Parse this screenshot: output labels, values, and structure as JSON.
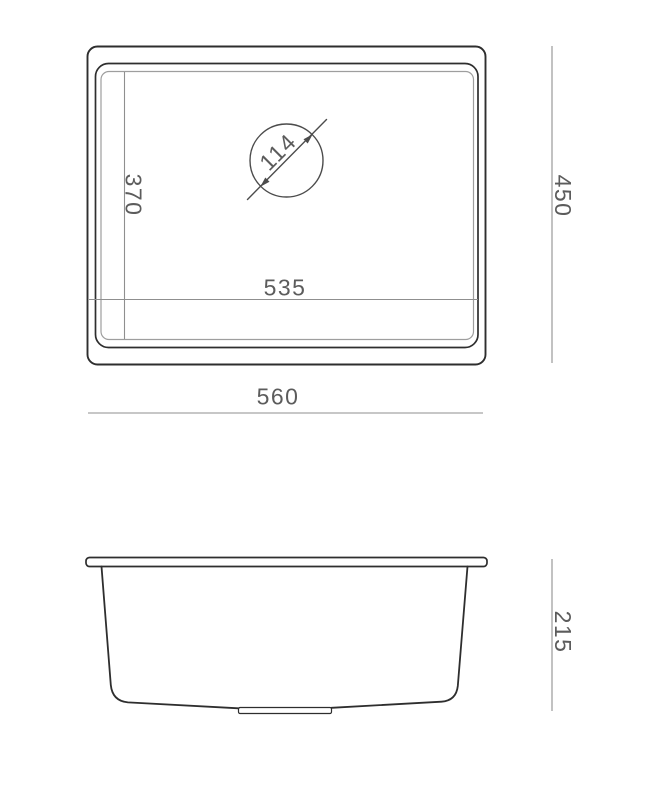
{
  "drawing": {
    "background": "#ffffff",
    "colors": {
      "outline": "#2e2e2e",
      "light_outline": "#9e9e9e",
      "dimension_line": "#8f8f8f",
      "annotation": "#4c4c4c",
      "text": "#5c5c5c"
    },
    "top_view": {
      "labels": {
        "drain_diameter": "114",
        "inner_depth": "370",
        "inner_width": "535",
        "outer_depth": "450",
        "outer_width": "560"
      }
    },
    "side_view": {
      "labels": {
        "height": "215"
      }
    }
  }
}
